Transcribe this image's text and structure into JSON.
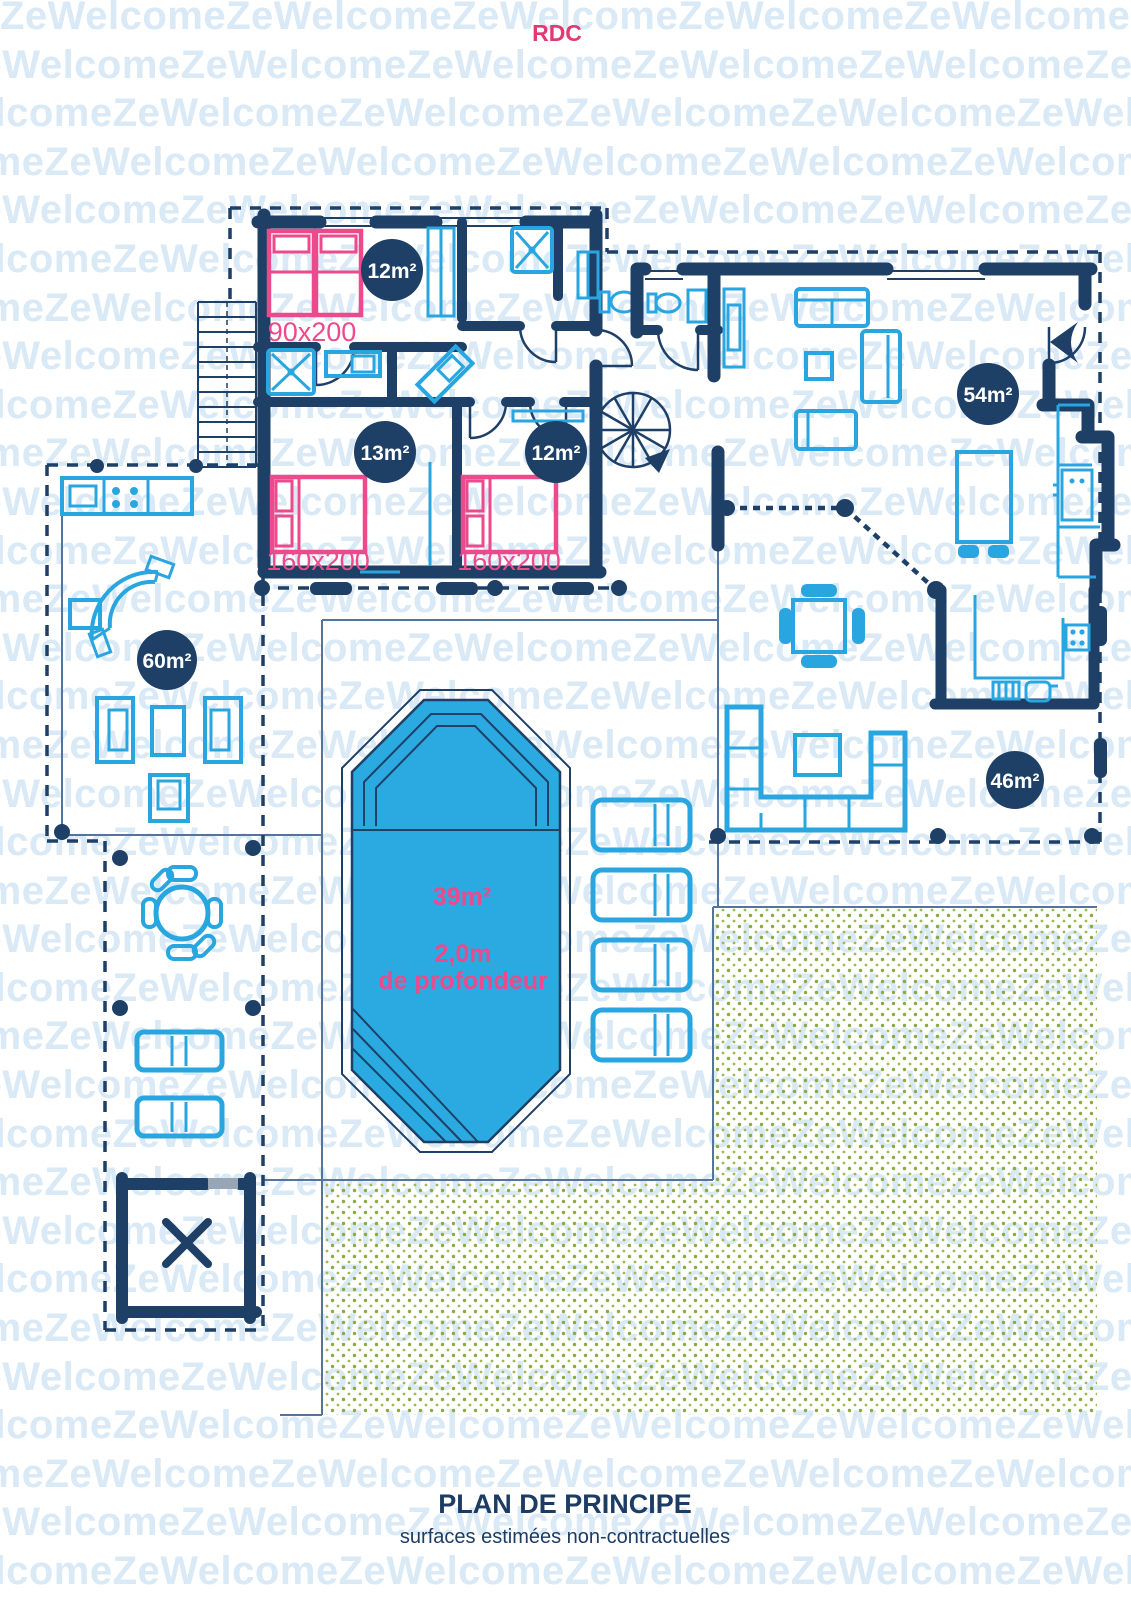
{
  "floor": {
    "title": "RDC"
  },
  "watermark": {
    "text": "ZeWelcome"
  },
  "badges": [
    {
      "label": "12m²"
    },
    {
      "label": "13m²"
    },
    {
      "label": "12m²"
    },
    {
      "label": "54m²"
    },
    {
      "label": "60m²"
    },
    {
      "label": "46m²"
    }
  ],
  "bed_labels": [
    "90x200",
    "160x200",
    "160x200"
  ],
  "pool": {
    "area": "39m²",
    "depth_value": "2,0m",
    "depth_caption": "de profondeur"
  },
  "footer": {
    "title": "PLAN DE PRINCIPE",
    "subtitle": "surfaces estimées non-contractuelles"
  },
  "colors": {
    "wall_navy": "#1e3f66",
    "furniture_blue": "#29a6e0",
    "accent_pink": "#ec4a8c",
    "pool_water": "#2baae1",
    "watermark_blue": "#d9e9f6",
    "grass_green": "#8aab41"
  }
}
